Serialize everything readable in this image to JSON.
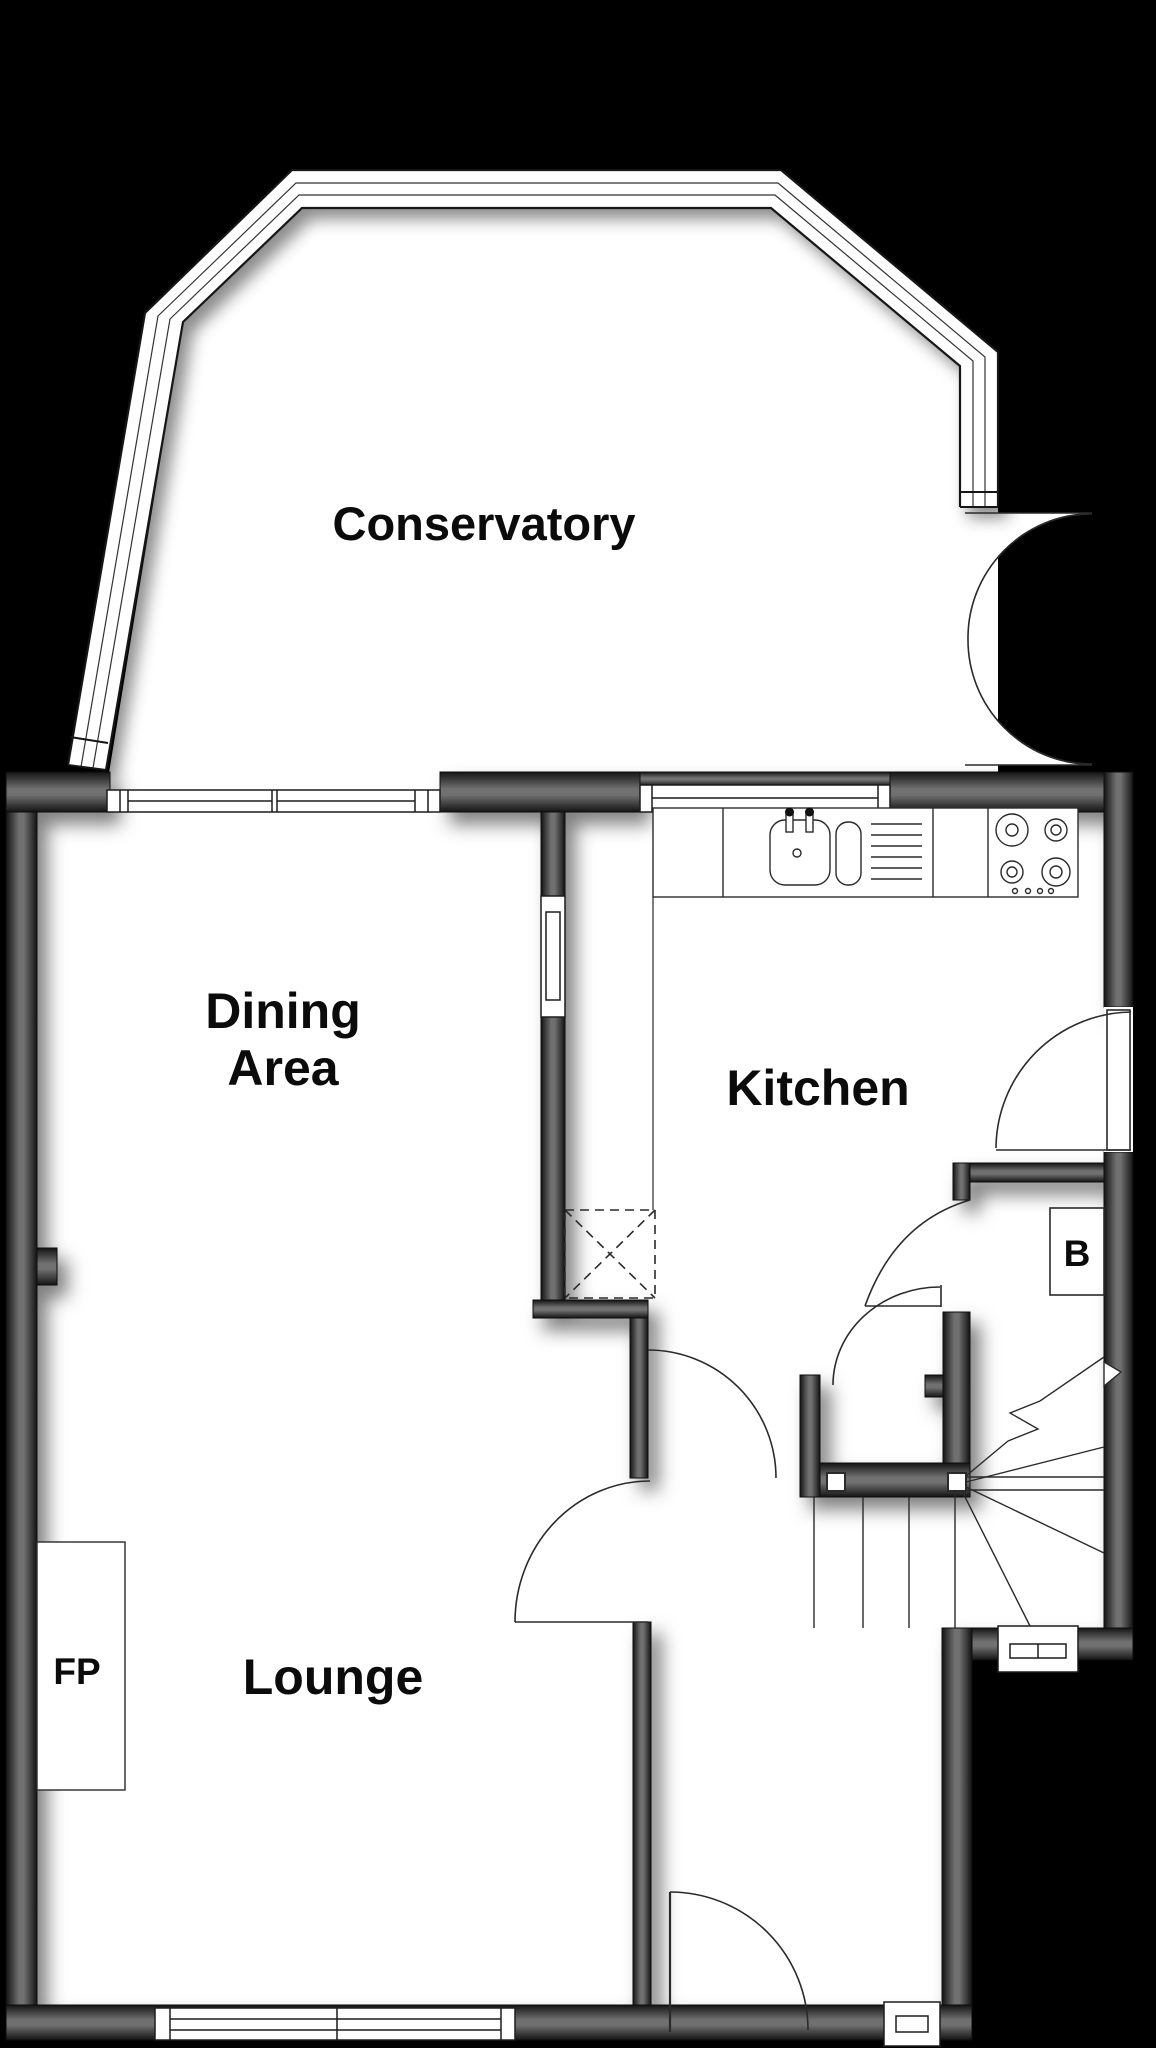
{
  "plan": {
    "type": "floor-plan",
    "labels": {
      "conservatory": "Conservatory",
      "dining_line1": "Dining",
      "dining_line2": "Area",
      "kitchen": "Kitchen",
      "lounge": "Lounge",
      "fireplace": "FP",
      "boiler": "B"
    },
    "fixtures": [
      "sink-with-drainer-icon",
      "four-ring-hob-icon",
      "winder-staircase",
      "fireplace-recess",
      "boiler-cupboard",
      "serving-hatch-window",
      "chimney-dashed-box",
      "french-doors",
      "front-door",
      "internal-doors"
    ],
    "palette": {
      "background": "#000000",
      "floor": "#ffffff",
      "wall_edge": "#141414",
      "wall_mid": "#6f6f6f",
      "line": "#1c1c1c"
    }
  }
}
